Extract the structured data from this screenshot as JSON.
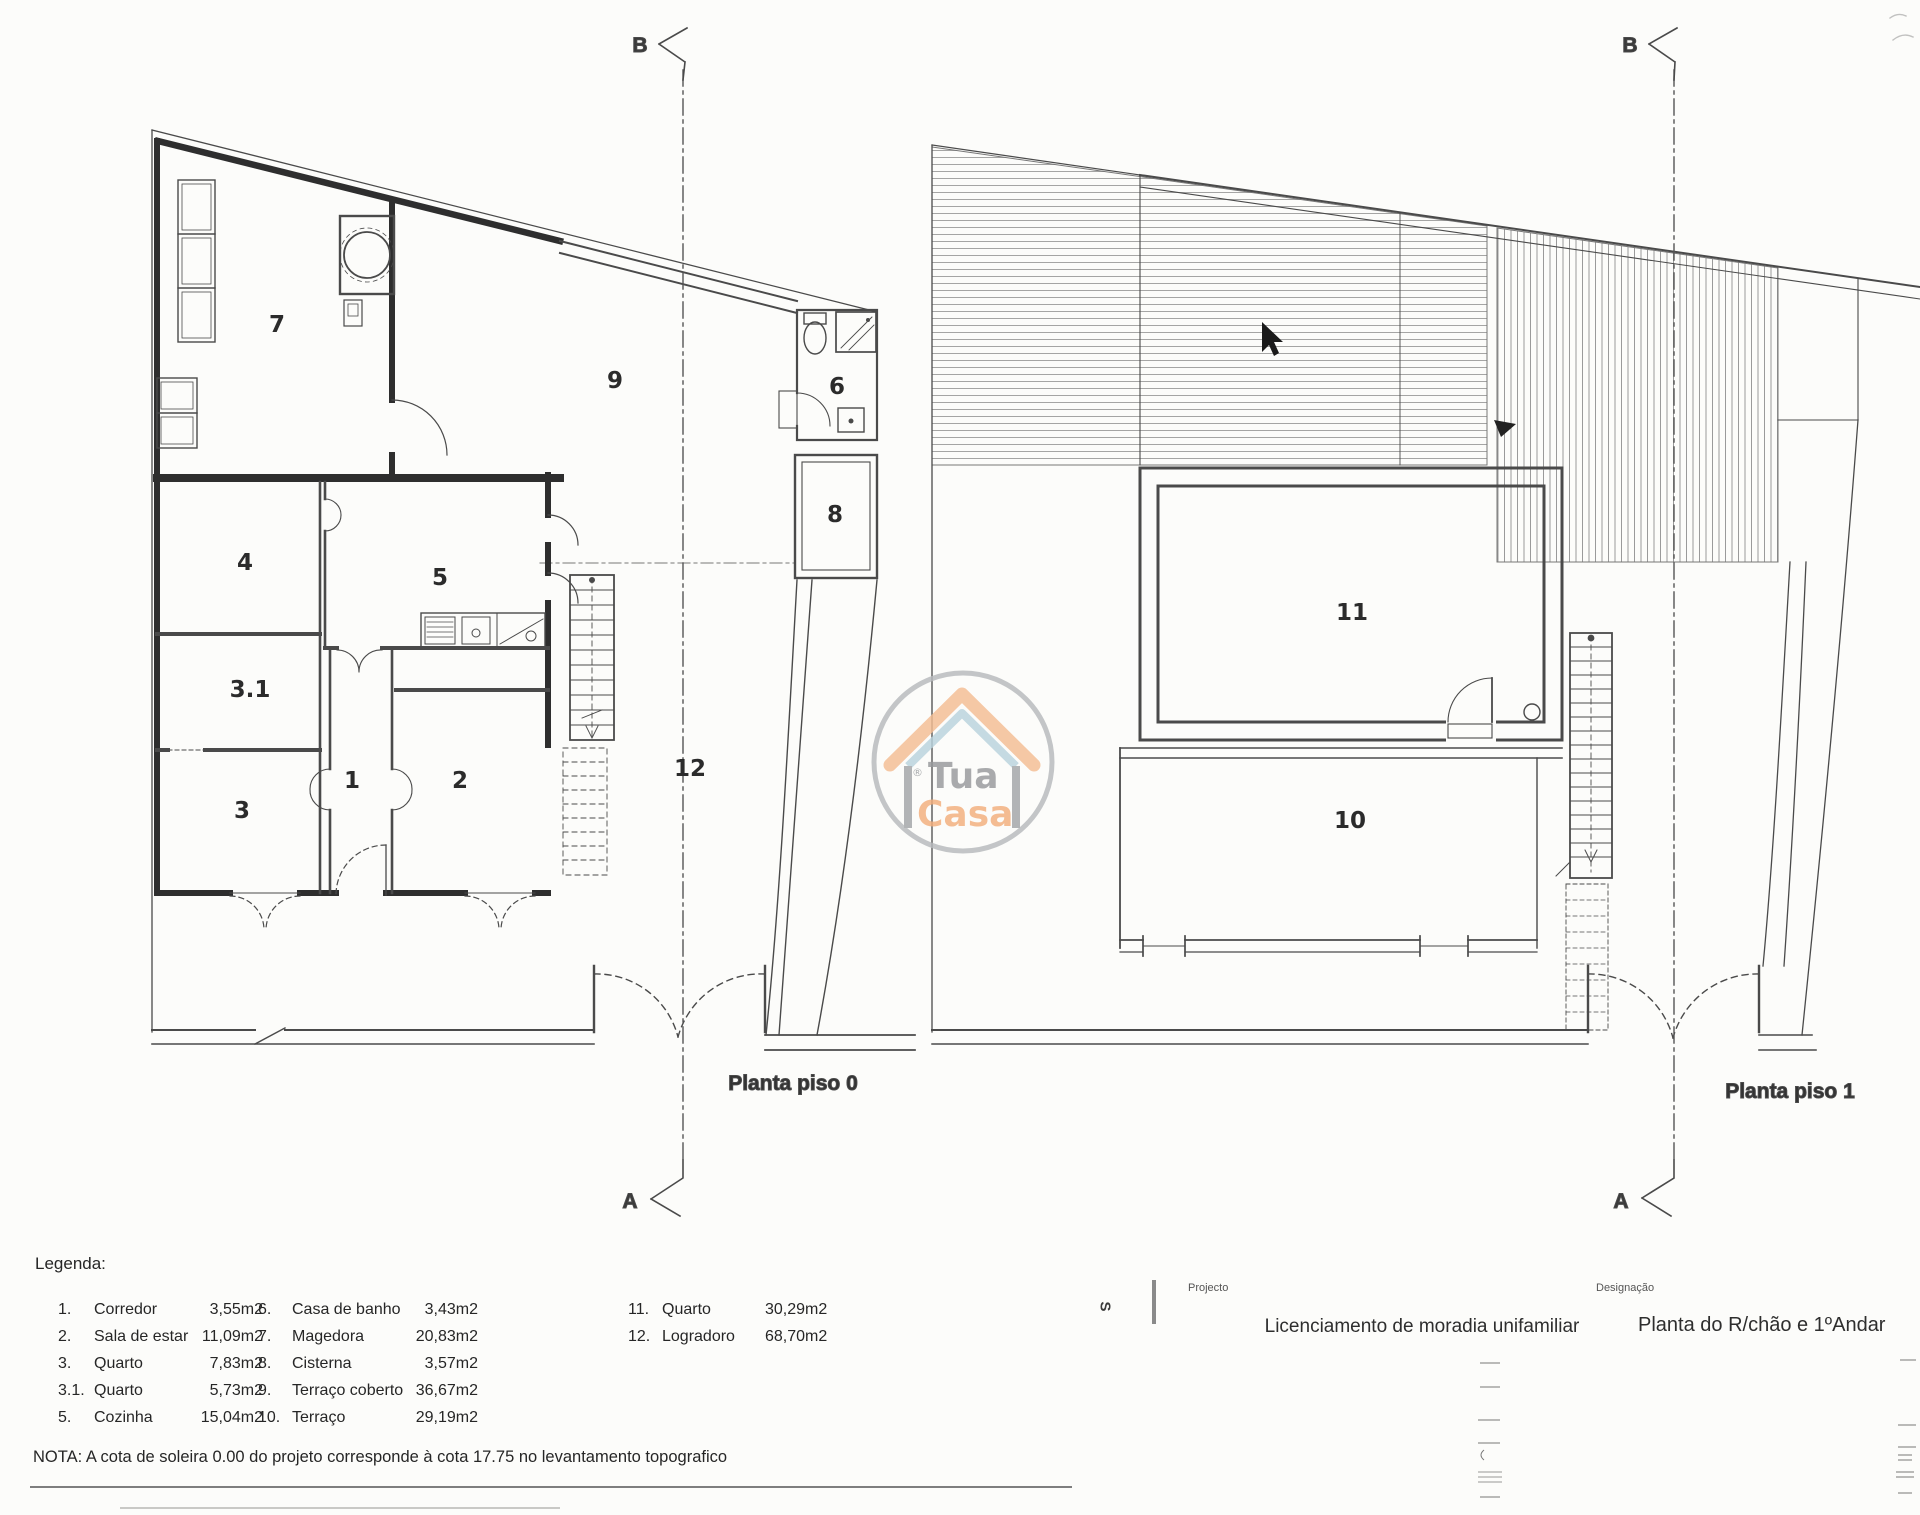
{
  "plan_left": {
    "caption": "Planta piso 0",
    "section_marker_top": "B",
    "section_marker_bottom": "A",
    "rooms": {
      "corridor": "1",
      "living_room": "2",
      "bedroom_3": "3",
      "bedroom_31": "3.1",
      "bedroom_4": "4",
      "kitchen": "5",
      "bathroom": "6",
      "magedora": "7",
      "cistern": "8",
      "covered_terrace": "9",
      "yard": "12"
    }
  },
  "plan_right": {
    "caption": "Planta piso 1",
    "section_marker_top": "B",
    "section_marker_bottom": "A",
    "rooms": {
      "bedroom_11": "11",
      "terrace": "10"
    }
  },
  "legend": {
    "title": "Legenda:",
    "col1": [
      {
        "num": "1.",
        "name": "Corredor",
        "area": "3,55m2"
      },
      {
        "num": "2.",
        "name": "Sala de estar",
        "area": "11,09m2"
      },
      {
        "num": "3.",
        "name": "Quarto",
        "area": "7,83m2"
      },
      {
        "num": "3.1.",
        "name": "Quarto",
        "area": "5,73m2"
      },
      {
        "num": "5.",
        "name": "Cozinha",
        "area": "15,04m2"
      }
    ],
    "col2": [
      {
        "num": "6.",
        "name": "Casa de banho",
        "area": "3,43m2"
      },
      {
        "num": "7.",
        "name": "Magedora",
        "area": "20,83m2"
      },
      {
        "num": "8.",
        "name": "Cisterna",
        "area": "3,57m2"
      },
      {
        "num": "9.",
        "name": "Terraço coberto",
        "area": "36,67m2"
      },
      {
        "num": "10.",
        "name": "Terraço",
        "area": "29,19m2"
      }
    ],
    "col3": [
      {
        "num": "11.",
        "name": "Quarto",
        "area": "30,29m2"
      },
      {
        "num": "12.",
        "name": "Logradoro",
        "area": "68,70m2"
      }
    ]
  },
  "note": "NOTA: A cota de soleira 0.00 do projeto corresponde à cota 17.75 no levantamento topografico",
  "title_block": {
    "side_letter": "S",
    "project_label": "Projecto",
    "project": "Licenciamento de moradia unifamiliar",
    "designation_label": "Designação",
    "designation": "Planta do R/chão e 1ºAndar"
  },
  "logo": {
    "reg": "®",
    "word1": "Tua",
    "word2": "Casa",
    "colors": {
      "circle": "#b7babd",
      "roof": "#f4bd93",
      "inner_roof": "#b9d3dd",
      "house": "#a2a5a8",
      "text_grey": "#97999c",
      "text_orange": "#f3ae7c"
    }
  }
}
